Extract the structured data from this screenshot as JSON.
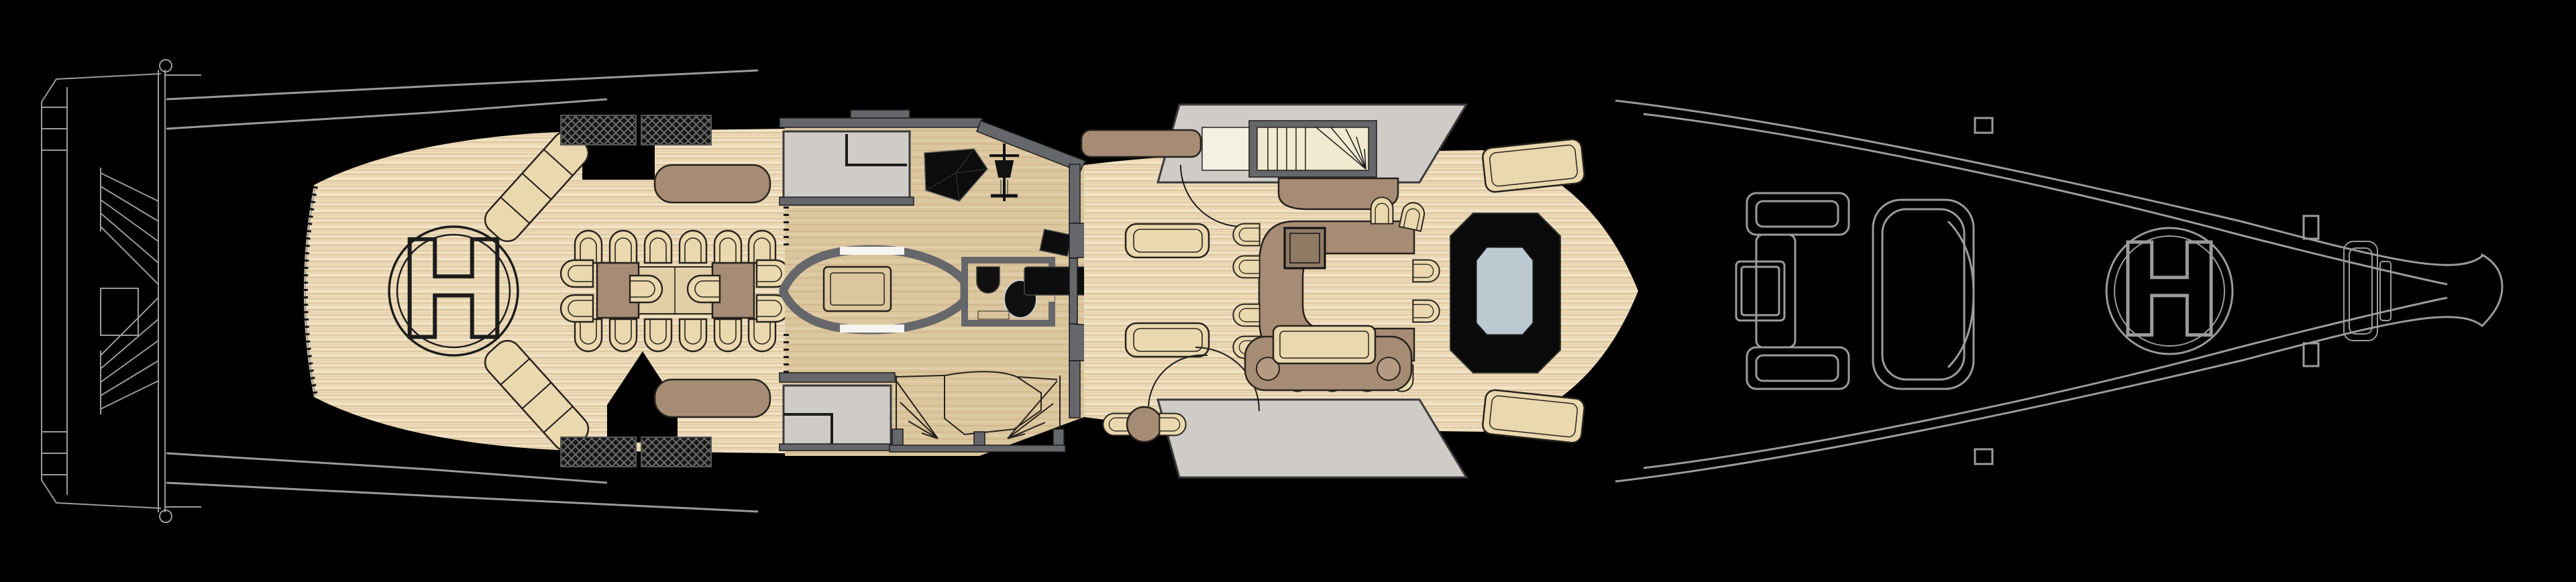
{
  "plan": {
    "aft_helipad": {
      "label": "H"
    },
    "fore_helipad": {
      "label": "H"
    },
    "palette": {
      "background": "#000000",
      "linework": "#9b9b9b",
      "teak": "#eddcb8",
      "teak_stripe": "#d9c49e",
      "interior_floor": "#dcc69e",
      "wall": "#66676b",
      "light_structure": "#cfccc8",
      "stair_tread": "#f2ead0",
      "furniture_brown": "#a68c74",
      "furniture_tan": "#ead8ae",
      "furniture_black": "#0d0d0d",
      "pool_water": "#bcc9d1",
      "outline_dark": "#26221c"
    },
    "features": [
      "swim-platform",
      "stern-stairs",
      "aft-helipad",
      "curved-sofas",
      "al-fresco-dining",
      "deck-vents",
      "sideboards",
      "salon-interior",
      "pantry-room",
      "grand-piano",
      "mast-sculpture",
      "elevator-pod",
      "day-head",
      "interior-staircase",
      "chaise-lounges",
      "exterior-bar",
      "bar-grill",
      "wing-staircase",
      "sun-bed",
      "bistro-set",
      "pool",
      "sun-pads",
      "tender-chocks",
      "fore-helipad",
      "bow-locker"
    ]
  }
}
